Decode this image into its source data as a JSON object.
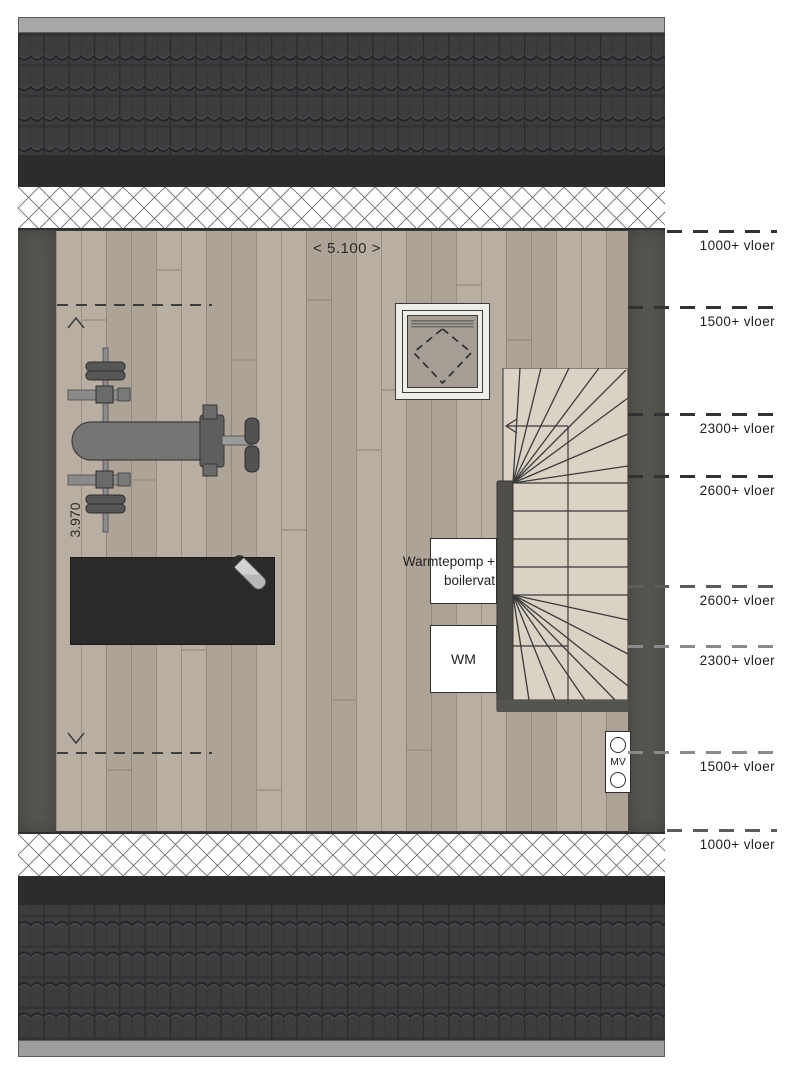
{
  "annotations": {
    "width_dim": "< 5.100 >",
    "depth_dim": "3.970"
  },
  "equipment": {
    "heatpump_line1": "Warmtepomp +",
    "heatpump_line2": "boilervat",
    "washing_machine": "WM",
    "ventilation": "MV"
  },
  "height_lines": [
    {
      "label": "1000+ vloer"
    },
    {
      "label": "1500+ vloer"
    },
    {
      "label": "2300+ vloer"
    },
    {
      "label": "2600+ vloer"
    },
    {
      "label": "2600+ vloer"
    },
    {
      "label": "2300+ vloer"
    },
    {
      "label": "1500+ vloer"
    },
    {
      "label": "1000+ vloer"
    }
  ],
  "colors": {
    "roof_tile": "#3c3d3e",
    "ridge": "#a8a8a8",
    "eave": "#2b2c2d",
    "wall": "#56554f",
    "floor_wood": "#b4aa9d",
    "stair_wood": "#d9d2c5"
  }
}
